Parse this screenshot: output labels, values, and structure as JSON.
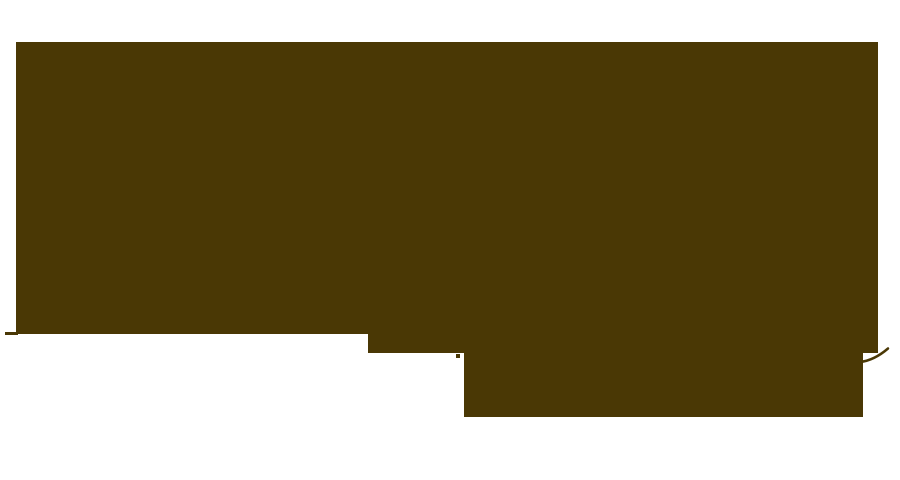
{
  "canvas": {
    "width": 900,
    "height": 480,
    "background": "#ffffff"
  },
  "silhouette": {
    "description": "Large solid dark-brown abstract silhouette occupying most of the frame; stepped bottom edge descending toward lower right, small tick mark protruding at lower left, tiny detached dot below the middle step, and a thin swash curve trailing off the right edge.",
    "color": "#4a3805",
    "rects": [
      {
        "name": "main-block",
        "x": 16,
        "y": 42,
        "w": 862,
        "h": 292
      },
      {
        "name": "middle-step-block",
        "x": 368,
        "y": 333,
        "w": 510,
        "h": 20
      },
      {
        "name": "lower-right-block",
        "x": 464,
        "y": 352,
        "w": 399,
        "h": 65
      },
      {
        "name": "left-tick-mark",
        "x": 5,
        "y": 332,
        "w": 13,
        "h": 3
      },
      {
        "name": "small-dot",
        "x": 456,
        "y": 354,
        "w": 4,
        "h": 4
      }
    ],
    "strokes": [
      {
        "name": "right-swash-curve",
        "path": "M860,362 Q874,360.5 888,348.5",
        "width": 2.5
      }
    ]
  }
}
